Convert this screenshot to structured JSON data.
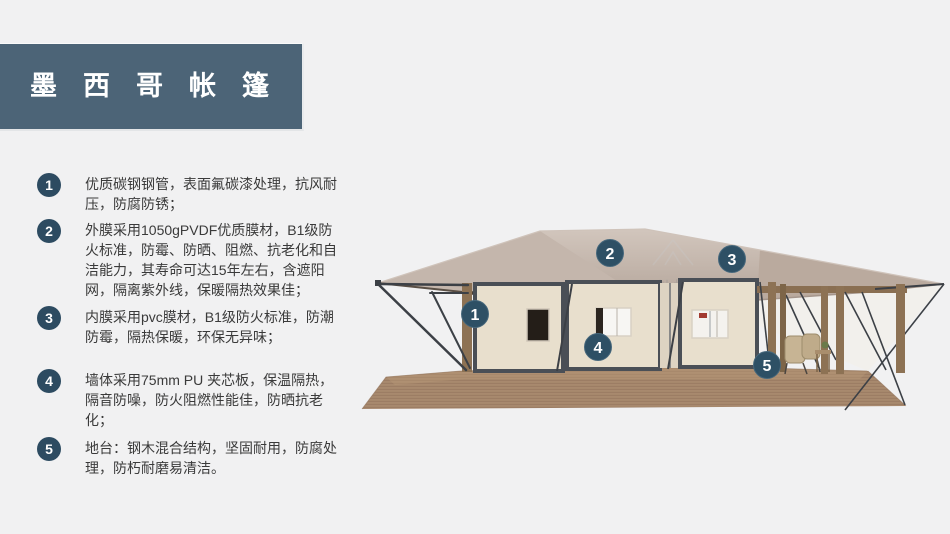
{
  "page": {
    "background": "#f1f1f2"
  },
  "banner": {
    "title": "墨西哥帐篷",
    "bg_color": "#4c6477",
    "text_color": "#ffffff"
  },
  "features": [
    {
      "number": "1",
      "text": "优质碳钢钢管，表面氟碳漆处理，抗风耐压，防腐防锈；"
    },
    {
      "number": "2",
      "text": "外膜采用1050gPVDF优质膜材，B1级防火标准，防霉、防晒、阻燃、抗老化和自洁能力，其寿命可达15年左右，含遮阳网，隔离紫外线，保暖隔热效果佳；"
    },
    {
      "number": "3",
      "text": "内膜采用pvc膜材，B1级防火标准，防潮防霉，隔热保暖，环保无异味；"
    },
    {
      "number": "4",
      "text": "墙体采用75mm PU 夹芯板，保温隔热，隔音防噪，防火阻燃性能佳，防晒抗老化；"
    },
    {
      "number": "5",
      "text": "地台：钢木混合结构，坚固耐用，防腐处理，防朽耐磨易清洁。"
    }
  ],
  "illustration": {
    "callouts": [
      {
        "number": "1"
      },
      {
        "number": "2"
      },
      {
        "number": "3"
      },
      {
        "number": "4"
      },
      {
        "number": "5"
      }
    ],
    "watermark": {
      "line1": "雪利帐篷",
      "line2": "XUELI TENT"
    },
    "colors": {
      "roof": "#c4b6ac",
      "wall": "#e8dfcd",
      "frame": "#4a4f56",
      "deck": "#a8896e",
      "wood_post": "#8d7254",
      "brace": "#3c4046",
      "callout_bg": "#2e5065",
      "badge_bg": "#2d4b61"
    }
  }
}
